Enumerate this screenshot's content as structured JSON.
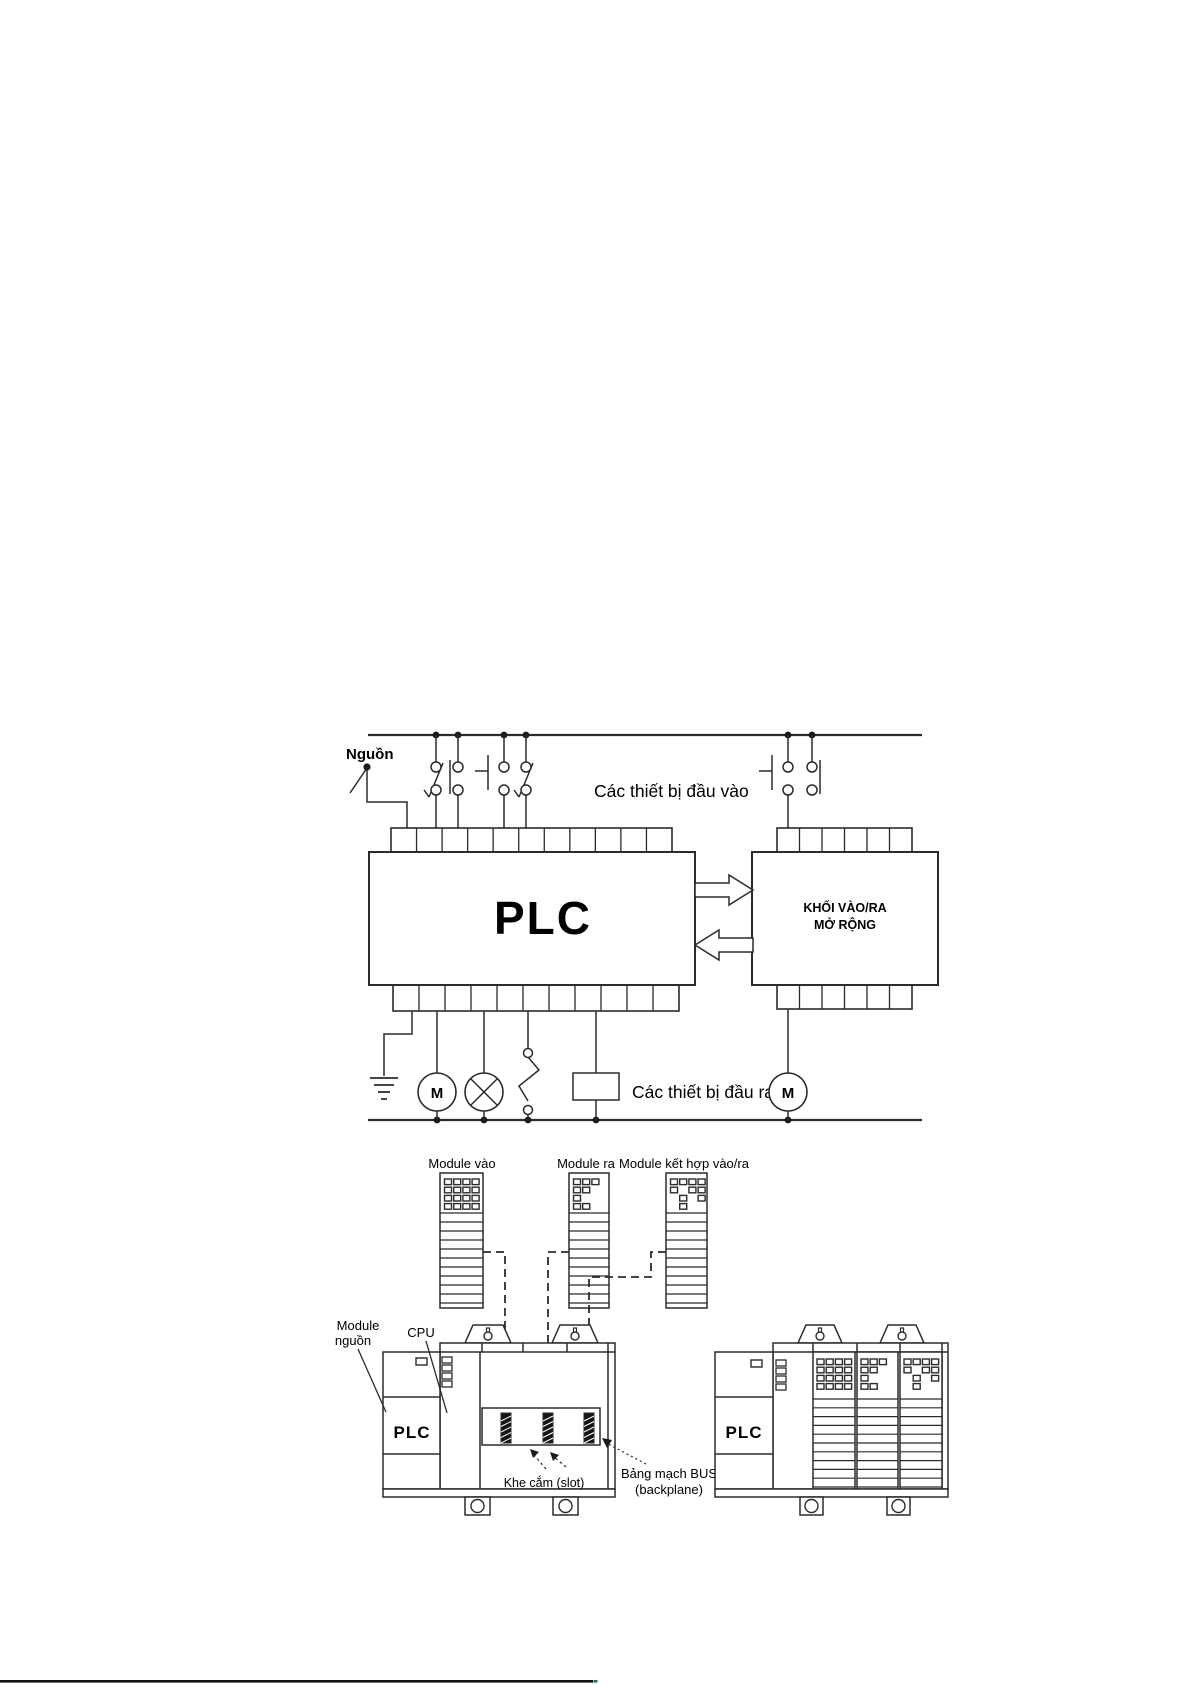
{
  "diagram1": {
    "power_label": "Nguồn",
    "inputs_label": "Các thiết bị đầu vào",
    "outputs_label": "Các thiết bị đầu ra",
    "plc_label": "PLC",
    "expansion_line1": "KHỐI VÀO/RA",
    "expansion_line2": "MỞ RỘNG",
    "motor_left_label": "M",
    "motor_right_label": "M"
  },
  "diagram2": {
    "module_in_label": "Module vào",
    "module_out_label": "Module ra",
    "module_combo_label": "Module kết hợp vào/ra",
    "power_module_line1": "Module",
    "power_module_line2": "nguồn",
    "cpu_label": "CPU",
    "plc_left_label": "PLC",
    "plc_right_label": "PLC",
    "slot_label": "Khe cắm (slot)",
    "backplane_line1": "Bảng mạch BUS",
    "backplane_line2": "(backplane)"
  },
  "colors": {
    "ink": "#2b2b2b",
    "text": "#000000",
    "background": "#ffffff",
    "footer_line": "#111111"
  }
}
